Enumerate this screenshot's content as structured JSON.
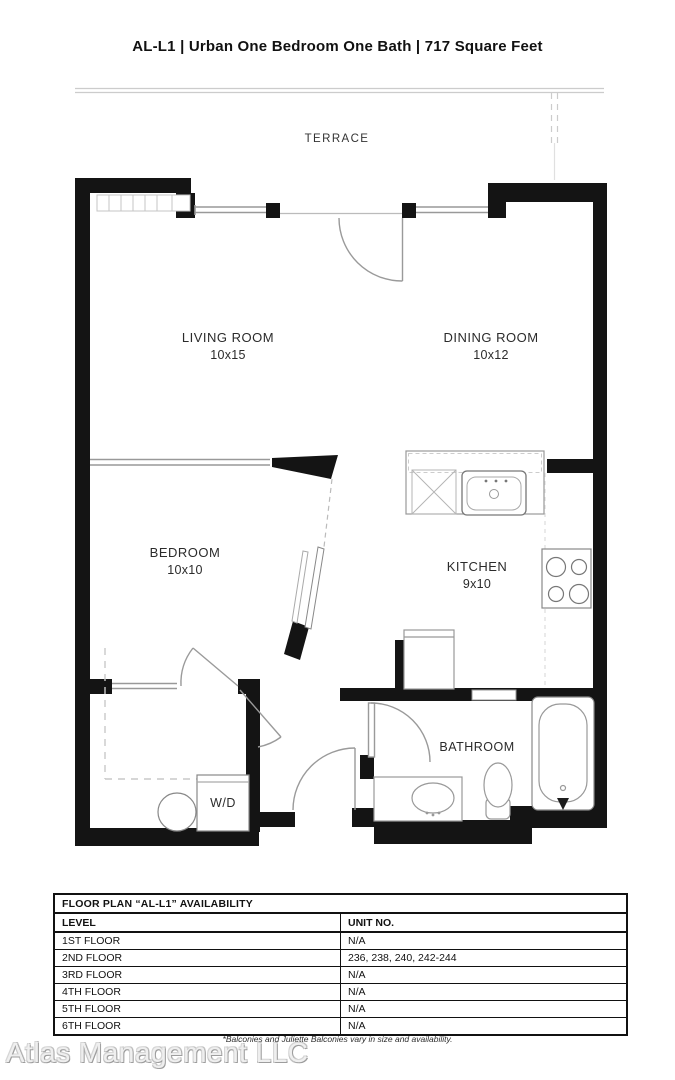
{
  "title": "AL-L1 | Urban One Bedroom One Bath | 717 Square Feet",
  "floor_plan": {
    "terrace_label": "TERRACE",
    "rooms": {
      "living": {
        "name": "LIVING ROOM",
        "dims": "10x15"
      },
      "dining": {
        "name": "DINING ROOM",
        "dims": "10x12"
      },
      "bedroom": {
        "name": "BEDROOM",
        "dims": "10x10"
      },
      "kitchen": {
        "name": "KITCHEN",
        "dims": "9x10"
      },
      "bathroom": {
        "name": "BATHROOM"
      },
      "laundry": {
        "name": "W/D"
      }
    },
    "colors": {
      "wall": "#141414",
      "thin_line": "#999999",
      "dashed_line": "#c9c9c9"
    }
  },
  "availability": {
    "title": "FLOOR PLAN “AL-L1” AVAILABILITY",
    "columns": {
      "level": "LEVEL",
      "unit": "UNIT NO."
    },
    "rows": [
      {
        "level": "1ST FLOOR",
        "units": "N/A"
      },
      {
        "level": "2ND FLOOR",
        "units": "236, 238, 240, 242-244"
      },
      {
        "level": "3RD FLOOR",
        "units": "N/A"
      },
      {
        "level": "4TH FLOOR",
        "units": "N/A"
      },
      {
        "level": "5TH FLOOR",
        "units": "N/A"
      },
      {
        "level": "6TH FLOOR",
        "units": "N/A"
      }
    ]
  },
  "footer": {
    "disclaimer": "*Balconies and Juliette Balconies vary in size and availability.",
    "watermark": "Atlas Management LLC"
  }
}
